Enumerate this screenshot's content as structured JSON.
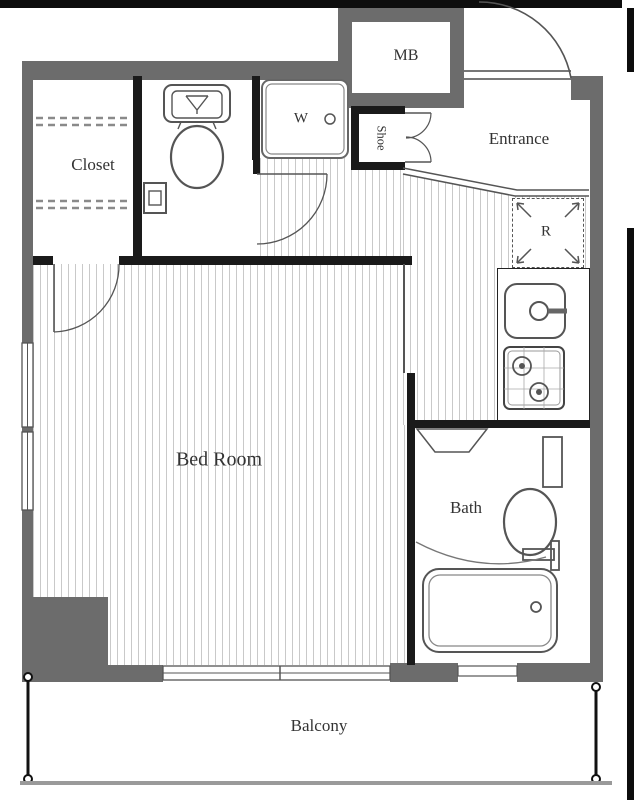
{
  "floorplan": {
    "labels": {
      "closet": "Closet",
      "bedroom": "Bed Room",
      "entrance": "Entrance",
      "bath": "Bath",
      "balcony": "Balcony",
      "meter_box": "MB",
      "refrigerator_space": "R",
      "washer_space": "W",
      "shoe_cabinet": "Shoe"
    },
    "colors": {
      "outer_wall": "#6c6c6c",
      "inner_wall": "#1a1a1a",
      "floor_stripe": "#c9c9c9",
      "fixture_line": "#555555",
      "label_text": "#333333",
      "frame_black": "#0d0d0d"
    }
  }
}
